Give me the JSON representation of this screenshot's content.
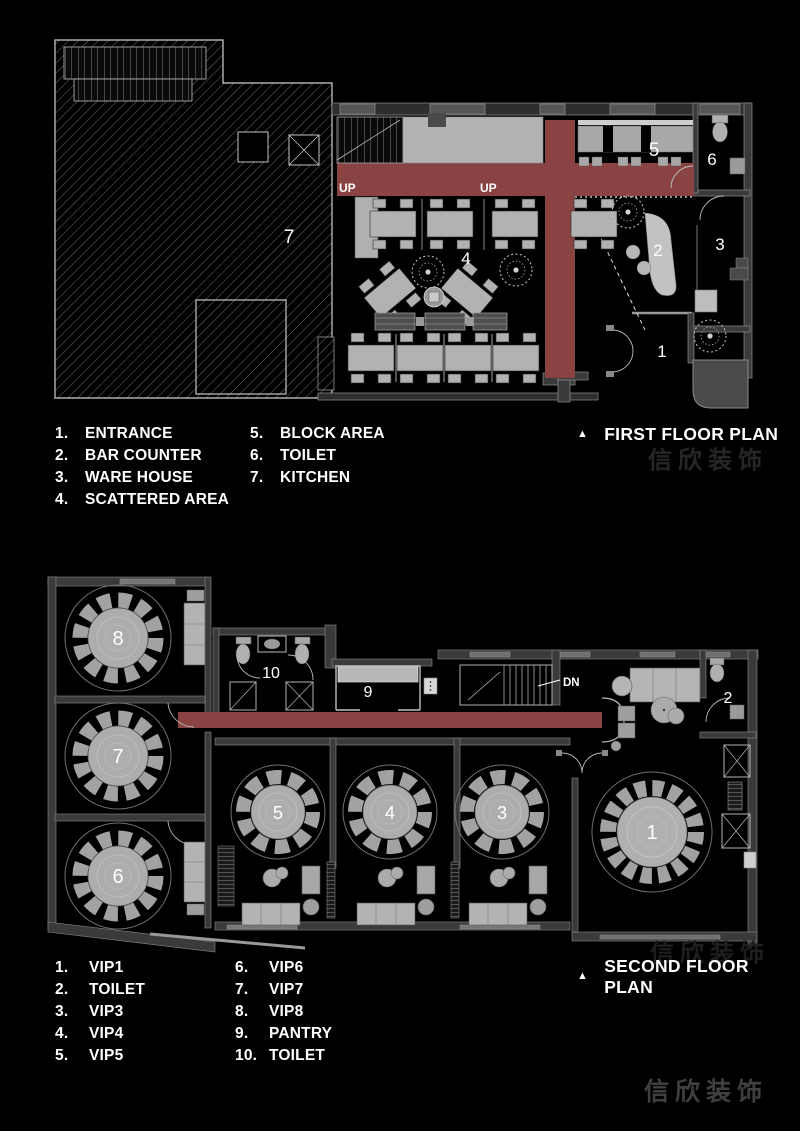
{
  "first_floor": {
    "title": "FIRST FLOOR PLAN",
    "legend": [
      {
        "num": "1.",
        "label": "ENTRANCE"
      },
      {
        "num": "2.",
        "label": "BAR COUNTER"
      },
      {
        "num": "3.",
        "label": "WARE HOUSE"
      },
      {
        "num": "4.",
        "label": "SCATTERED AREA"
      },
      {
        "num": "5.",
        "label": "BLOCK AREA"
      },
      {
        "num": "6.",
        "label": "TOILET"
      },
      {
        "num": "7.",
        "label": "KITCHEN"
      }
    ],
    "rooms": {
      "n1": "1",
      "n2": "2",
      "n3": "3",
      "n4": "4",
      "n5": "5",
      "n6": "6",
      "n7": "7"
    },
    "up_label_left": "UP",
    "up_label_right": "UP"
  },
  "second_floor": {
    "title": "SECOND FLOOR PLAN",
    "legend": [
      {
        "num": "1.",
        "label": "VIP1"
      },
      {
        "num": "2.",
        "label": "TOILET"
      },
      {
        "num": "3.",
        "label": "VIP3"
      },
      {
        "num": "4.",
        "label": "VIP4"
      },
      {
        "num": "5.",
        "label": "VIP5"
      },
      {
        "num": "6.",
        "label": "VIP6"
      },
      {
        "num": "7.",
        "label": "VIP7"
      },
      {
        "num": "8.",
        "label": "VIP8"
      },
      {
        "num": "9.",
        "label": "PANTRY"
      },
      {
        "num": "10.",
        "label": "TOILET"
      }
    ],
    "rooms": {
      "n1": "1",
      "n2": "2",
      "n3": "3",
      "n4": "4",
      "n5": "5",
      "n6": "6",
      "n7": "7",
      "n8": "8",
      "n9": "9",
      "n10": "10"
    },
    "dn_label": "DN"
  },
  "watermark": {
    "text": "信欣装饰"
  },
  "colors": {
    "background": "#000000",
    "corridor_red": "#8a4343",
    "furniture_gray": "#b2b2b2",
    "wall_gray": "#3a3a3a",
    "label_white": "#ffffff",
    "watermark_gray": "#3f3f3f"
  }
}
